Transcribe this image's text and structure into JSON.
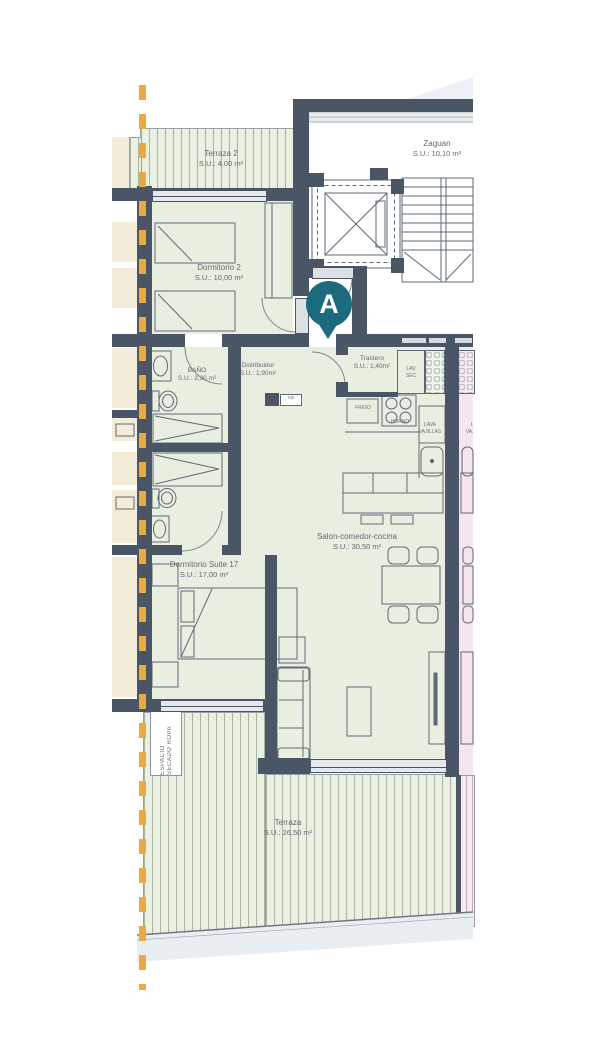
{
  "marker": "A",
  "rooms": {
    "terraza2": {
      "name": "Terraza 2",
      "area": "S.U.:  4.00 m²"
    },
    "zaguan": {
      "name": "Zaguan",
      "area": "S.U.:  10,10 m²"
    },
    "dormitorio2": {
      "name": "Dormitorio 2",
      "area": "S.U.: 10,00 m²"
    },
    "trastero": {
      "name": "Trastero",
      "area": "S.U.: 1,40m²"
    },
    "bano": {
      "name": "BAÑO",
      "area": "S.U.: 3,30 m²"
    },
    "distribuidor": {
      "name": "Distribuidor",
      "area": "S.U.: 1,90m²"
    },
    "salon": {
      "name": "Salon-comedor-cocina",
      "area": "S.U.: 30,50 m²"
    },
    "suite": {
      "name": "Dormitorio Suite 17",
      "area": "S.U.: 17,00 m²"
    },
    "terraza": {
      "name": "Terraza",
      "area": "S.U.: 26,50 m²"
    }
  },
  "appliances": {
    "frigo": "FRIGO",
    "horno": "HORNO",
    "lav": {
      "l1": "LAV",
      "l2": "SEC"
    },
    "lavavajillas": {
      "l1": "LAVA",
      "l2": "VAJILLAS"
    },
    "cb": "CB"
  },
  "drying": {
    "l1": "ESPACIO",
    "l2": "SECADO ROPA"
  },
  "colors": {
    "wall": "#4a5565",
    "room_green": "#e9efe0",
    "terrace_hatch_green": "#ebf1e2",
    "neighbor_pink": "#f6e4ef",
    "neighbor_cream": "#f3ecd9",
    "boundary_yellow": "#edaa3c",
    "marker_teal": "#1b6a7e"
  }
}
